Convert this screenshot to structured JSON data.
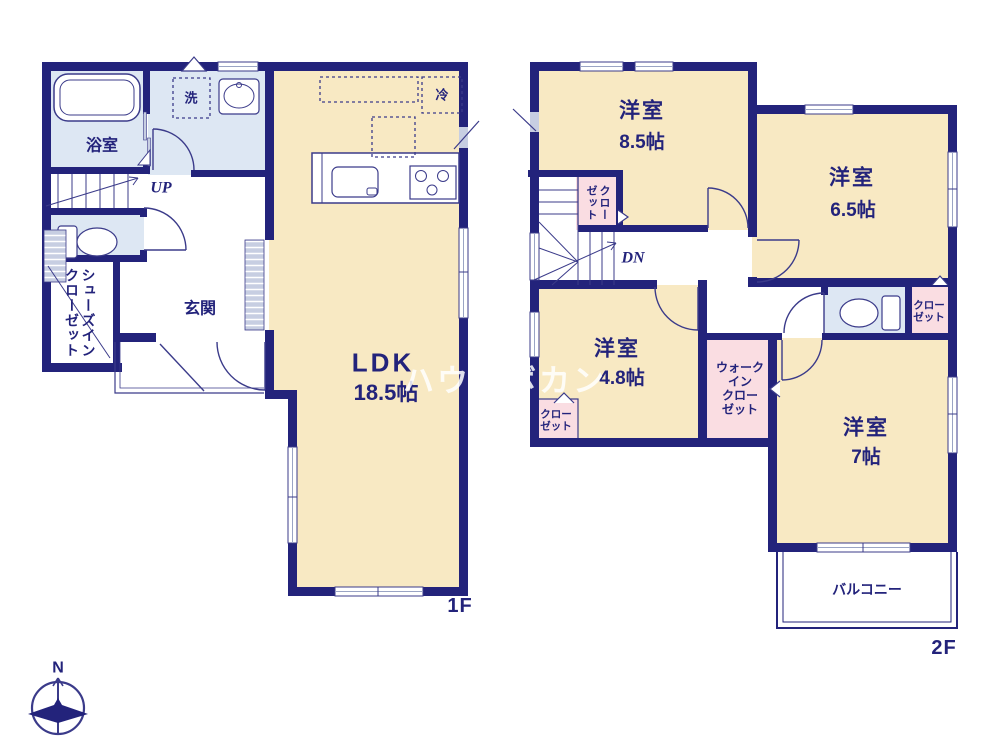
{
  "watermark": "ハウスボカン",
  "compass": {
    "north": "N"
  },
  "floor1": {
    "label": "1F",
    "bathroom": "浴室",
    "laundry": "洗",
    "refrigerator": "冷",
    "stairs": "UP",
    "entrance": "玄関",
    "shoes_closet": "シューズイン\nクローゼット",
    "ldk": {
      "name": "LDK",
      "size": "18.5帖"
    }
  },
  "floor2": {
    "label": "2F",
    "stairs": "DN",
    "bedroom_85": {
      "name": "洋室",
      "size": "8.5帖"
    },
    "bedroom_65": {
      "name": "洋室",
      "size": "6.5帖"
    },
    "bedroom_48": {
      "name": "洋室",
      "size": "4.8帖"
    },
    "bedroom_7": {
      "name": "洋室",
      "size": "7帖"
    },
    "closet_hall": "クロー\nゼット",
    "closet_65": "クロー\nゼット",
    "closet_48": "クロー\nゼット",
    "walk_in_closet": "ウォーク\nイン\nクロー\nゼット",
    "balcony": "バルコニー"
  },
  "colors": {
    "wall": "#23237b",
    "thin_line": "#3b3b8a",
    "room_cream": "#f8e9c3",
    "room_blue": "#dde7f3",
    "room_pink": "#fadde2",
    "fitting_grey": "#c7cee2"
  }
}
